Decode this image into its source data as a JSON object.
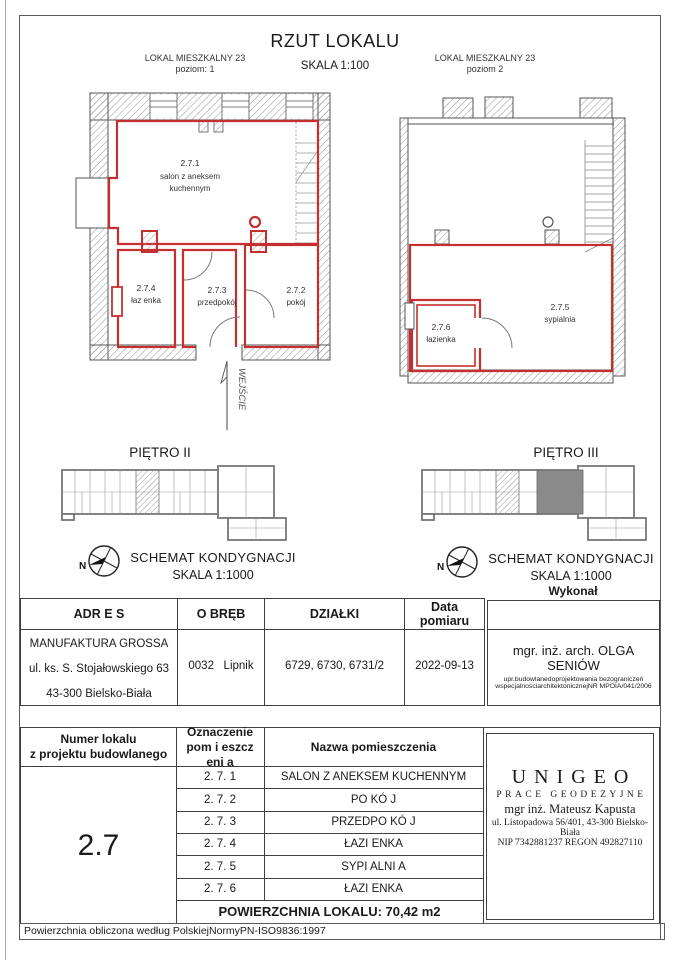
{
  "title": {
    "main": "RZUT LOKALU",
    "scale": "SKALA 1:100"
  },
  "plans": {
    "left": {
      "header_line1": "LOKAL MIESZKALNY 23",
      "header_line2": "poziom: 1",
      "entrance_label": "WEJŚCIE",
      "rooms": {
        "salon": {
          "id": "2.7.1",
          "name1": "salon z aneksem",
          "name2": "kuchennym"
        },
        "lazienka": {
          "id": "2.7.4",
          "name": "łaz enka"
        },
        "przedpokoj": {
          "id": "2.7.3",
          "name": "przedpokój"
        },
        "pokoj": {
          "id": "2.7.2",
          "name": "pokój"
        }
      }
    },
    "right": {
      "header_line1": "LOKAL MIESZKALNY 23",
      "header_line2": "poziom 2",
      "rooms": {
        "sypialnia": {
          "id": "2.7.5",
          "name": "sypialnia"
        },
        "lazienka": {
          "id": "2.7.6",
          "name": "łazienka"
        }
      }
    }
  },
  "floors": {
    "left": {
      "title": "PIĘTRO II",
      "schemat": "SCHEMAT KONDYGNACJI",
      "scale": "SKALA 1:1000",
      "compass": "N"
    },
    "right": {
      "title": "PIĘTRO III",
      "schemat": "SCHEMAT KONDYGNACJI",
      "scale": "SKALA 1:1000",
      "compass": "N",
      "wykonal": "Wykonał"
    }
  },
  "info_table": {
    "headers": {
      "adres": "ADR E S",
      "obreb": "O BRĘB",
      "dzialki": "DZIAŁKI",
      "data": "Data pomiaru"
    },
    "adres": [
      "MANUFAKTURA GROSSA",
      "ul. ks. S. Stojałowskiego 63",
      "43-300 Bielsko-Biała"
    ],
    "obreb": "0032   Lipnik",
    "dzialki": "6729, 6730, 6731/2",
    "data": "2022-09-13"
  },
  "executor": {
    "name": "mgr. inż. arch. OLGA SENIÓW",
    "cred1": "upr.budowlanedoprojektowania bezograniczeń",
    "cred2": "wspecjalnościarchitektonicznejNR MPOIA/041/2006"
  },
  "rooms_table": {
    "headers": {
      "col1a": "Numer lokalu",
      "col1b": "z projektu budowlanego",
      "col2a": "Oznaczenie",
      "col2b": "pom i eszcz eni a",
      "col3": "Nazwa pomieszczenia"
    },
    "lokal_number": "2.7",
    "rows": [
      {
        "id": "2. 7. 1",
        "name": "SALON Z ANEKSEM KUCHENNYM"
      },
      {
        "id": "2. 7. 2",
        "name": "PO KÓ J"
      },
      {
        "id": "2. 7. 3",
        "name": "PRZEDPO KÓ J"
      },
      {
        "id": "2. 7. 4",
        "name": "ŁAZI ENKA"
      },
      {
        "id": "2. 7. 5",
        "name": "SYPI ALNI A"
      },
      {
        "id": "2. 7. 6",
        "name": "ŁAZI ENKA"
      }
    ],
    "area": "POWIERZCHNIA LOKALU: 70,42 m2"
  },
  "unigeo": {
    "name": "UNIGEO",
    "subtitle": "PRACE GEODEZYJNE",
    "person": "mgr inż. Mateusz Kapusta",
    "address": "ul. Listopadowa 56/401, 43-300 Bielsko-Biała",
    "nip": "NIP 7342881237 REGON 492827110"
  },
  "footer": "Powierzchnia obliczona według PolskiejNormyPN-ISO9836:1997",
  "colors": {
    "red": "#c62f2f",
    "wall": "#555555"
  }
}
